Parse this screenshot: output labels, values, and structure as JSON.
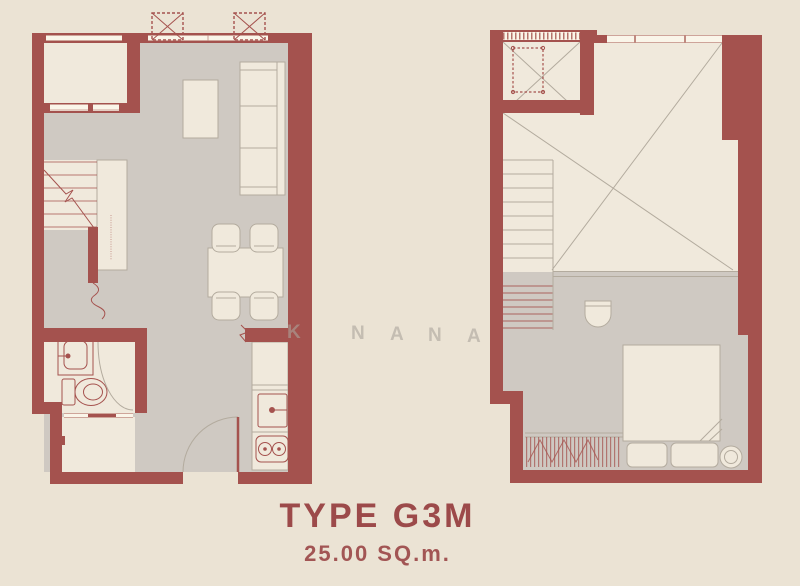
{
  "title": {
    "type": "TYPE G3M",
    "area": "25.00 SQ.m."
  },
  "watermark": {
    "letters": [
      "K",
      "N",
      "A",
      "N",
      "A"
    ]
  },
  "colors": {
    "background": "#EBE3D4",
    "wall": "#A4524E",
    "floor": "#CFC9C2",
    "room": "#F0E9DC",
    "lineGray": "#B3AB9E",
    "lineRed": "#A5524E",
    "titleText": "#9C4A4A",
    "watermarkText": "#ABA59C"
  }
}
